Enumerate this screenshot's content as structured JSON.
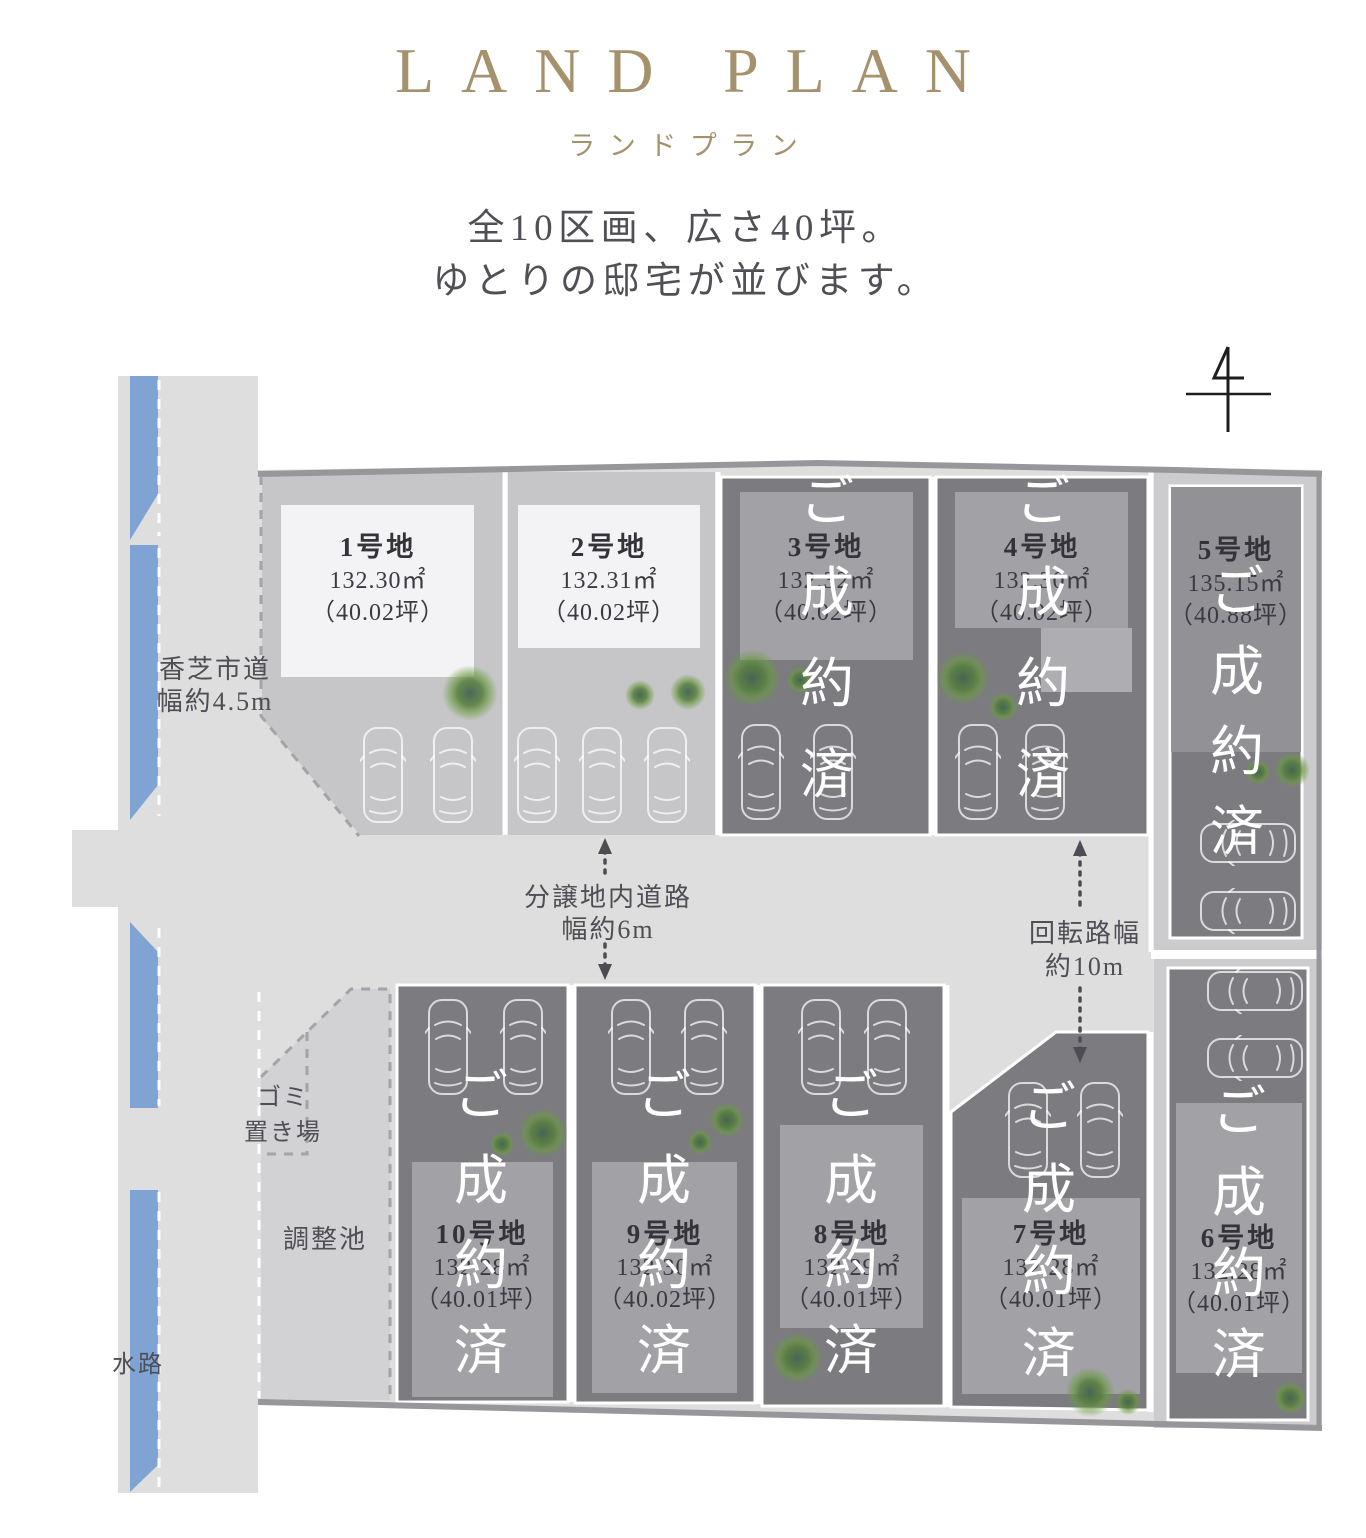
{
  "header": {
    "title": "LAND PLAN",
    "subtitle": "ランドプラン",
    "tagline_line1": "全10区画、広さ40坪。",
    "tagline_line2": "ゆとりの邸宅が並びます。"
  },
  "plan": {
    "sold_label": "ご成約済",
    "roads": {
      "city_road_line1": "香芝市道",
      "city_road_line2": "幅約4.5m",
      "internal_road_line1": "分譲地内道路",
      "internal_road_line2": "幅約6m",
      "turning_road_line1": "回転路幅",
      "turning_road_line2": "約10m"
    },
    "facilities": {
      "garbage_line1": "ゴミ",
      "garbage_line2": "置き場",
      "retention_pond": "調整池",
      "waterway": "水路"
    },
    "lots": [
      {
        "name": "1号地",
        "area": "132.30㎡",
        "tsubo": "（40.02坪）",
        "sold": false
      },
      {
        "name": "2号地",
        "area": "132.31㎡",
        "tsubo": "（40.02坪）",
        "sold": false
      },
      {
        "name": "3号地",
        "area": "132.32㎡",
        "tsubo": "（40.02坪）",
        "sold": true
      },
      {
        "name": "4号地",
        "area": "132.30㎡",
        "tsubo": "（40.02坪）",
        "sold": true
      },
      {
        "name": "5号地",
        "area": "135.15㎡",
        "tsubo": "（40.88坪）",
        "sold": true
      },
      {
        "name": "6号地",
        "area": "132.28㎡",
        "tsubo": "（40.01坪）",
        "sold": true
      },
      {
        "name": "7号地",
        "area": "132.28㎡",
        "tsubo": "（40.01坪）",
        "sold": true
      },
      {
        "name": "8号地",
        "area": "132.29㎡",
        "tsubo": "（40.01坪）",
        "sold": true
      },
      {
        "name": "9号地",
        "area": "132.30㎡",
        "tsubo": "（40.02坪）",
        "sold": true
      },
      {
        "name": "10号地",
        "area": "132.28㎡",
        "tsubo": "（40.01坪）",
        "sold": true
      }
    ],
    "colors": {
      "accent_gold": "#a6916d",
      "water_blue": "#7fa3d2",
      "road_gray": "#dedede",
      "lot_light": "#c6c6c9",
      "sold_overlay": "#7b7b80",
      "sold_house": "#a2a2a6",
      "available_house": "#f3f3f5",
      "tree_green": "#6b9c3f",
      "border_gray": "#97979b",
      "text_dark": "#4c4c52"
    }
  }
}
